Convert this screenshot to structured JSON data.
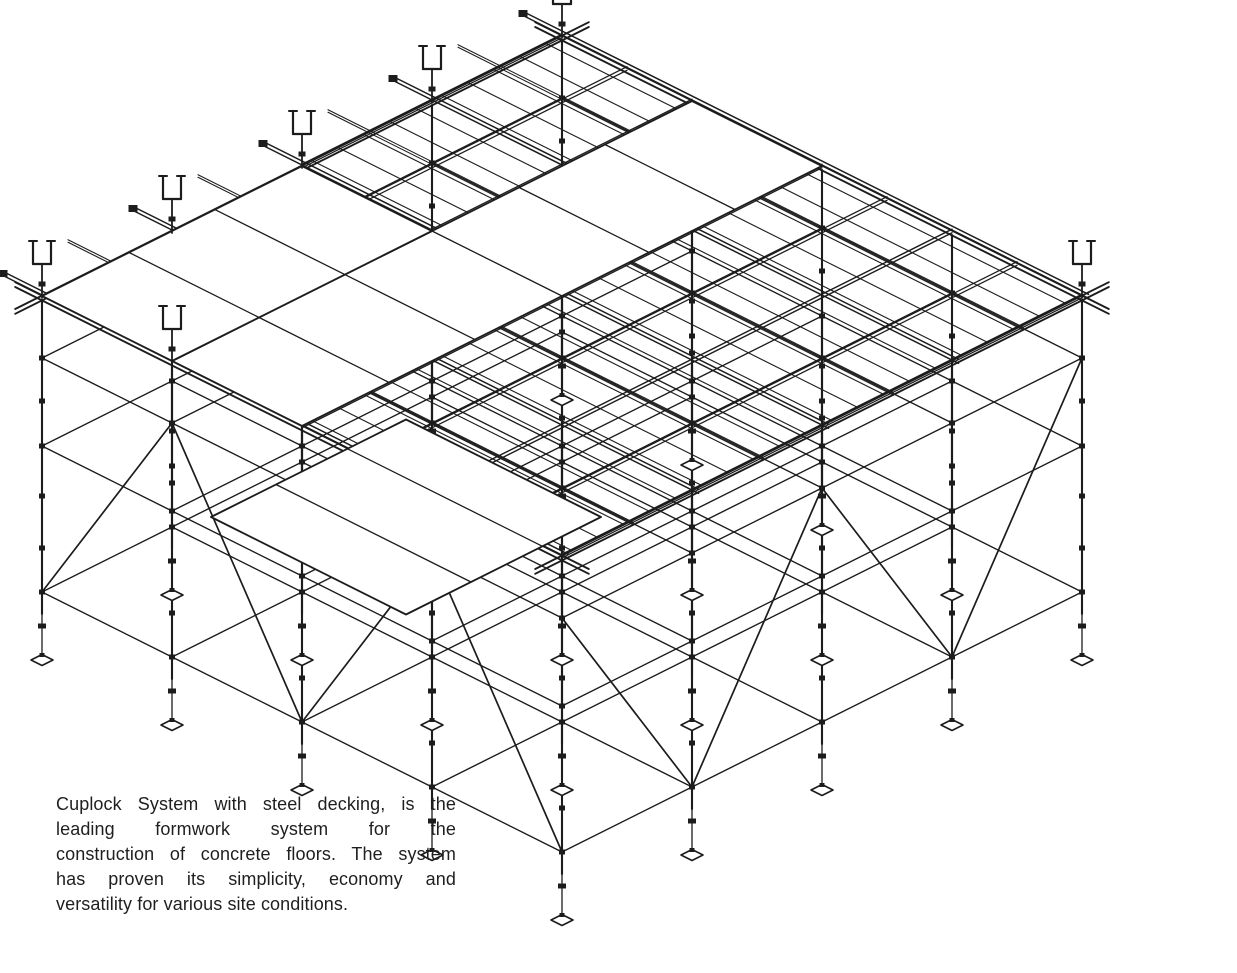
{
  "caption": {
    "text": "Cuplock System with steel decking, is the leading formwork system for the construction of concrete floors. The system has proven its simplicity, economy and versatility for various site conditions.",
    "lines": [
      "Cuplock System with steel decking, is the",
      "leading formwork system for the",
      "construction of concrete floors. The system",
      "has proven its simplicity, economy and",
      "versatility for various site conditions."
    ]
  },
  "drawing": {
    "subject": "cuplock-scaffolding-with-steel-decking",
    "view": "isometric",
    "background": "#ffffff",
    "stroke": "#1c1c1c",
    "panel_fill": "#ffffff",
    "width": 1237,
    "height": 973,
    "iso": {
      "cx": 562,
      "cy": 556,
      "ex": 130,
      "ey": -65,
      "nx": -130,
      "ny": -65,
      "bays": 4
    },
    "structure": {
      "leg_length": 318,
      "jack_length": 46,
      "top_ledger": 62,
      "ledger_levels": [
        62,
        150,
        296
      ],
      "cup_levels": [
        105,
        200,
        252
      ],
      "components": [
        "vertical-standard",
        "cup-joint",
        "horizontal-ledger",
        "diagonal-brace",
        "adjustable-base-jack",
        "base-plate",
        "u-head-jack",
        "primary-beam",
        "secondary-beam",
        "steel-deck-panel"
      ]
    },
    "deck": {
      "exposed_cells": [
        [
          0,
          0
        ],
        [
          1,
          0
        ],
        [
          2,
          0
        ],
        [
          3,
          0
        ],
        [
          0,
          1
        ],
        [
          1,
          1
        ],
        [
          2,
          1
        ],
        [
          3,
          1
        ],
        [
          2,
          3
        ],
        [
          3,
          3
        ]
      ],
      "panels": [
        {
          "i0": 0,
          "i1": 4,
          "j0": 2,
          "j1": 3,
          "div_i": [
            0.67,
            1.33,
            2,
            2.67,
            3.33
          ],
          "div_j": []
        },
        {
          "i0": 0,
          "i1": 2,
          "j0": 3,
          "j1": 4,
          "div_i": [
            0.67,
            1.33
          ],
          "div_j": []
        },
        {
          "i0": -1.05,
          "i1": 0.45,
          "j0": 0.15,
          "j1": 1.65,
          "div_i": [
            -0.55,
            0.0
          ],
          "div_j": []
        }
      ]
    },
    "uheads": [
      [
        0,
        3
      ],
      [
        0,
        4
      ],
      [
        1,
        4
      ],
      [
        2,
        4
      ],
      [
        3,
        4
      ],
      [
        4,
        4
      ],
      [
        4,
        0
      ]
    ]
  }
}
